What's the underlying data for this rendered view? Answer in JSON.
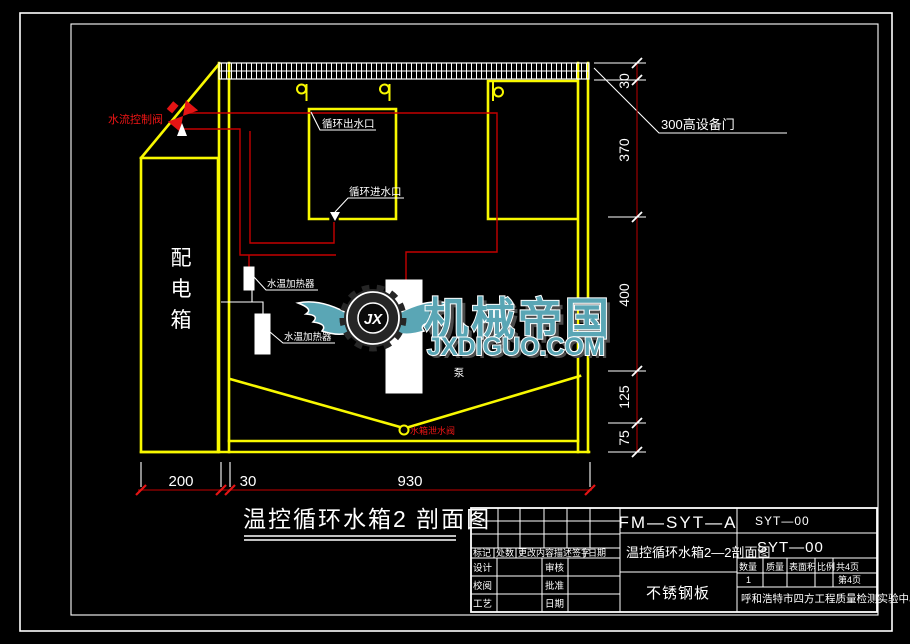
{
  "labels": {
    "flow_valve": "水流控制阀",
    "outlet": "循环出水口",
    "inlet": "循环进水口",
    "heater1": "水温加热器",
    "heater2": "水温加热器",
    "pump": "泵",
    "drain_valve": "水箱泄水阀",
    "equip_door": "300高设备门",
    "dist_box": [
      "配",
      "电",
      "箱"
    ]
  },
  "dimensions": {
    "right": [
      "30",
      "370",
      "400",
      "125",
      "75"
    ],
    "bottom": [
      "200",
      "30",
      "930"
    ]
  },
  "drawing_title": "温控循环水箱2 剖面图",
  "watermark": {
    "brand": "机械帝国",
    "site": "JXDIGUO.COM",
    "logo_text": "JX"
  },
  "title_block": {
    "code": "FM—SYT—A",
    "no_top": "SYT—00",
    "no_big": "SYT—00",
    "title": "温控循环水箱2—2剖面图",
    "material": "不锈钢板",
    "company": "呼和浩特市四方工程质量检测实验中心",
    "rev": {
      "mark": "标记",
      "count": "处数",
      "desc": "更改内容描述签字",
      "date": "日期"
    },
    "fields": {
      "design": "设计",
      "check": "审核",
      "review": "校阅",
      "approve": "批准",
      "craft": "工艺",
      "date": "日期"
    },
    "qty": {
      "qty": "数量",
      "mass": "质量",
      "area": "表面积",
      "scale": "比例",
      "pages": "共4页",
      "page": "第4页",
      "qty_val": "1"
    }
  },
  "colors": {
    "structure_yellow": "#f8f800",
    "wiring_red": "#c40000",
    "dimension_red": "#9c0000",
    "annotation_white": "#ffffff",
    "watermark_teal": "#5aa6b5"
  }
}
